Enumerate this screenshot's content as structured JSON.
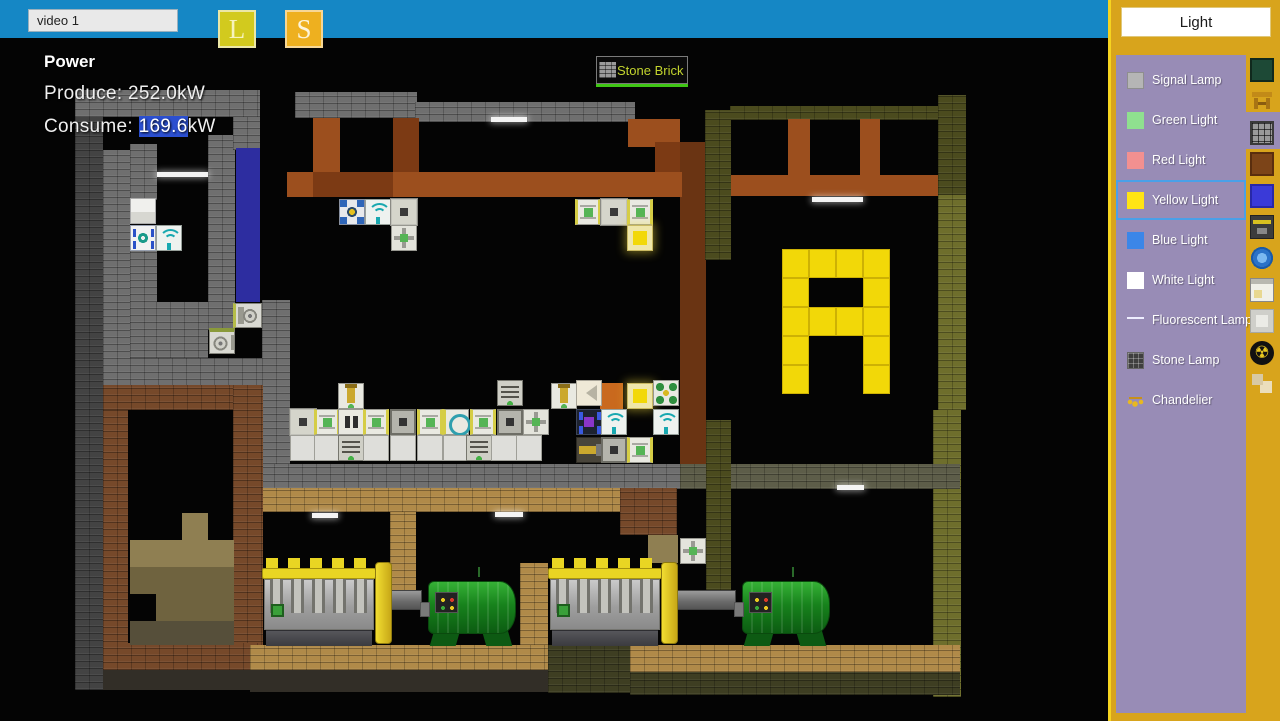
{
  "topbar": {
    "input_value": "video 1",
    "load_label": "L",
    "save_label": "S"
  },
  "power_panel": {
    "title": "Power",
    "produce": "Produce: 252.0kW",
    "consume_prefix": "Consume: ",
    "consume_highlight": "169.6",
    "consume_suffix": "kW"
  },
  "tooltip": {
    "label": "Stone Brick"
  },
  "sidebar": {
    "title": "Light",
    "items": [
      {
        "label": "Signal Lamp",
        "swatch": "signal",
        "selected": false
      },
      {
        "label": "Green Light",
        "swatch": "green",
        "selected": false
      },
      {
        "label": "Red Light",
        "swatch": "red",
        "selected": false
      },
      {
        "label": "Yellow Light",
        "swatch": "yellow",
        "selected": true
      },
      {
        "label": "Blue Light",
        "swatch": "blue",
        "selected": false
      },
      {
        "label": "White Light",
        "swatch": "white",
        "selected": false
      },
      {
        "label": "Fluorescent Lamp",
        "swatch": "fluorescent",
        "selected": false
      },
      {
        "label": "Stone Lamp",
        "swatch": "stone",
        "selected": false
      },
      {
        "label": "Chandelier",
        "swatch": "chandelier",
        "selected": false
      }
    ],
    "tabs": [
      {
        "icon": "nature-block-icon",
        "cls": "nature",
        "selected": false
      },
      {
        "icon": "furniture-icon",
        "cls": "furniture",
        "selected": false
      },
      {
        "icon": "lamp-grid-icon",
        "cls": "lamp",
        "selected": true
      },
      {
        "icon": "wood-block-icon",
        "cls": "wood",
        "selected": false
      },
      {
        "icon": "blue-block-icon",
        "cls": "blue",
        "selected": false
      },
      {
        "icon": "machine-icon",
        "cls": "machine",
        "selected": false
      },
      {
        "icon": "gear-coin-icon",
        "cls": "gear",
        "selected": false
      },
      {
        "icon": "window-icon",
        "cls": "window",
        "selected": false
      },
      {
        "icon": "plate-icon",
        "cls": "plate",
        "selected": false
      },
      {
        "icon": "radiation-icon",
        "cls": "radiation",
        "selected": false,
        "glyph": "☢"
      },
      {
        "icon": "blocks-icon",
        "cls": "blocks",
        "selected": false
      }
    ]
  },
  "colors": {
    "topbar_blue": "#1587c5",
    "sidebar_gold": "#d8a41c",
    "panel_purple": "#988cb6",
    "selection_blue": "#4aa0e8",
    "consume_highlight": "#2b4fd0",
    "lamp_yellow": "#f2d808",
    "tooltip_green": "#3fc614"
  },
  "world": {
    "blocks": [
      {
        "x": 75,
        "y": 90,
        "w": 185,
        "h": 27,
        "t": "stone"
      },
      {
        "x": 75,
        "y": 117,
        "w": 28,
        "h": 573,
        "t": "stone-d"
      },
      {
        "x": 103,
        "y": 150,
        "w": 27,
        "h": 237,
        "t": "stone"
      },
      {
        "x": 130,
        "y": 144,
        "w": 27,
        "h": 56,
        "t": "stone"
      },
      {
        "x": 130,
        "y": 250,
        "w": 27,
        "h": 108,
        "t": "stone"
      },
      {
        "x": 156,
        "y": 302,
        "w": 52,
        "h": 56,
        "t": "stone"
      },
      {
        "x": 208,
        "y": 135,
        "w": 27,
        "h": 195,
        "t": "stone"
      },
      {
        "x": 130,
        "y": 358,
        "w": 160,
        "h": 29,
        "t": "stone"
      },
      {
        "x": 233,
        "y": 117,
        "w": 27,
        "h": 33,
        "t": "stone"
      },
      {
        "x": 262,
        "y": 300,
        "w": 28,
        "h": 164,
        "t": "stone"
      },
      {
        "x": 236,
        "y": 148,
        "w": 24,
        "h": 154,
        "t": "blue"
      },
      {
        "x": 295,
        "y": 92,
        "w": 122,
        "h": 26,
        "t": "stone"
      },
      {
        "x": 415,
        "y": 102,
        "w": 220,
        "h": 20,
        "t": "stone"
      },
      {
        "x": 730,
        "y": 106,
        "w": 213,
        "h": 14,
        "t": "olive-d"
      },
      {
        "x": 313,
        "y": 118,
        "w": 27,
        "h": 56,
        "t": "wood"
      },
      {
        "x": 393,
        "y": 118,
        "w": 26,
        "h": 79,
        "t": "wood-d"
      },
      {
        "x": 628,
        "y": 119,
        "w": 52,
        "h": 28,
        "t": "wood"
      },
      {
        "x": 655,
        "y": 142,
        "w": 26,
        "h": 54,
        "t": "wood-d"
      },
      {
        "x": 680,
        "y": 142,
        "w": 26,
        "h": 322,
        "t": "wood-dd"
      },
      {
        "x": 287,
        "y": 172,
        "w": 395,
        "h": 25,
        "t": "wood"
      },
      {
        "x": 313,
        "y": 172,
        "w": 80,
        "h": 25,
        "t": "wood-d"
      },
      {
        "x": 730,
        "y": 175,
        "w": 213,
        "h": 21,
        "t": "wood"
      },
      {
        "x": 788,
        "y": 119,
        "w": 22,
        "h": 57,
        "t": "wood"
      },
      {
        "x": 860,
        "y": 119,
        "w": 20,
        "h": 57,
        "t": "wood"
      },
      {
        "x": 705,
        "y": 110,
        "w": 26,
        "h": 150,
        "t": "olive-d"
      },
      {
        "x": 938,
        "y": 95,
        "w": 28,
        "h": 100,
        "t": "olive-d"
      },
      {
        "x": 938,
        "y": 195,
        "w": 28,
        "h": 215,
        "t": "olive"
      },
      {
        "x": 933,
        "y": 410,
        "w": 28,
        "h": 287,
        "t": "olive"
      },
      {
        "x": 260,
        "y": 464,
        "w": 420,
        "h": 25,
        "t": "stone"
      },
      {
        "x": 680,
        "y": 464,
        "w": 280,
        "h": 25,
        "t": "stone-o"
      },
      {
        "x": 262,
        "y": 488,
        "w": 360,
        "h": 24,
        "t": "tan"
      },
      {
        "x": 620,
        "y": 488,
        "w": 57,
        "h": 47,
        "t": "brown"
      },
      {
        "x": 648,
        "y": 535,
        "w": 30,
        "h": 28,
        "t": "khaki1"
      },
      {
        "x": 706,
        "y": 420,
        "w": 25,
        "h": 170,
        "t": "olive-d"
      },
      {
        "x": 390,
        "y": 512,
        "w": 26,
        "h": 80,
        "t": "tan"
      },
      {
        "x": 520,
        "y": 563,
        "w": 28,
        "h": 82,
        "t": "tan"
      },
      {
        "x": 103,
        "y": 385,
        "w": 25,
        "h": 285,
        "t": "brown"
      },
      {
        "x": 103,
        "y": 385,
        "w": 157,
        "h": 25,
        "t": "brown"
      },
      {
        "x": 233,
        "y": 385,
        "w": 30,
        "h": 285,
        "t": "brown"
      },
      {
        "x": 103,
        "y": 643,
        "w": 157,
        "h": 27,
        "t": "brown"
      },
      {
        "x": 103,
        "y": 670,
        "w": 157,
        "h": 20,
        "t": "dark"
      },
      {
        "x": 182,
        "y": 513,
        "w": 26,
        "h": 27,
        "t": "khaki1"
      },
      {
        "x": 130,
        "y": 540,
        "w": 104,
        "h": 27,
        "t": "khaki1"
      },
      {
        "x": 130,
        "y": 567,
        "w": 104,
        "h": 27,
        "t": "khaki2"
      },
      {
        "x": 156,
        "y": 594,
        "w": 78,
        "h": 27,
        "t": "khaki2"
      },
      {
        "x": 130,
        "y": 621,
        "w": 104,
        "h": 24,
        "t": "khaki3"
      },
      {
        "x": 250,
        "y": 645,
        "w": 300,
        "h": 25,
        "t": "tan"
      },
      {
        "x": 250,
        "y": 670,
        "w": 298,
        "h": 22,
        "t": "dark"
      },
      {
        "x": 548,
        "y": 645,
        "w": 84,
        "h": 48,
        "t": "olive-dd"
      },
      {
        "x": 630,
        "y": 645,
        "w": 330,
        "h": 27,
        "t": "tan"
      },
      {
        "x": 630,
        "y": 672,
        "w": 330,
        "h": 23,
        "t": "olive-dd"
      },
      {
        "x": 600,
        "y": 383,
        "w": 23,
        "h": 26,
        "t": "orange"
      }
    ],
    "machines": [
      {
        "x": 339,
        "y": 199,
        "t": "bluecorner"
      },
      {
        "x": 365,
        "y": 199,
        "t": "wifi"
      },
      {
        "x": 391,
        "y": 199,
        "t": "graysq"
      },
      {
        "x": 391,
        "y": 225,
        "t": "arrow4"
      },
      {
        "x": 575,
        "y": 199,
        "t": "splitter"
      },
      {
        "x": 601,
        "y": 199,
        "t": "graysq"
      },
      {
        "x": 627,
        "y": 199,
        "t": "splitter"
      },
      {
        "x": 627,
        "y": 225,
        "t": "lampglow"
      },
      {
        "x": 338,
        "y": 383,
        "t": "piston"
      },
      {
        "x": 497,
        "y": 380,
        "t": "lined"
      },
      {
        "x": 551,
        "y": 383,
        "t": "piston"
      },
      {
        "x": 576,
        "y": 380,
        "t": "funnel"
      },
      {
        "x": 627,
        "y": 383,
        "t": "lampglow"
      },
      {
        "x": 653,
        "y": 380,
        "t": "green4"
      },
      {
        "x": 290,
        "y": 409,
        "t": "graysq"
      },
      {
        "x": 314,
        "y": 409,
        "t": "splitter"
      },
      {
        "x": 338,
        "y": 409,
        "t": "doubleslot"
      },
      {
        "x": 363,
        "y": 409,
        "t": "splitter"
      },
      {
        "x": 390,
        "y": 409,
        "t": "darksq"
      },
      {
        "x": 417,
        "y": 409,
        "t": "splitter"
      },
      {
        "x": 443,
        "y": 409,
        "t": "tealgear"
      },
      {
        "x": 470,
        "y": 409,
        "t": "splitter"
      },
      {
        "x": 497,
        "y": 409,
        "t": "darksq"
      },
      {
        "x": 523,
        "y": 409,
        "t": "arrow4"
      },
      {
        "x": 576,
        "y": 409,
        "t": "purple"
      },
      {
        "x": 601,
        "y": 409,
        "t": "wifi"
      },
      {
        "x": 653,
        "y": 409,
        "t": "wifi"
      },
      {
        "x": 290,
        "y": 435,
        "t": "plain"
      },
      {
        "x": 314,
        "y": 435,
        "t": "plain"
      },
      {
        "x": 338,
        "y": 435,
        "t": "lined"
      },
      {
        "x": 363,
        "y": 435,
        "t": "plain"
      },
      {
        "x": 390,
        "y": 435,
        "t": "plain"
      },
      {
        "x": 417,
        "y": 435,
        "t": "plain"
      },
      {
        "x": 443,
        "y": 435,
        "t": "plain"
      },
      {
        "x": 466,
        "y": 435,
        "t": "lined"
      },
      {
        "x": 491,
        "y": 435,
        "t": "plain"
      },
      {
        "x": 516,
        "y": 435,
        "t": "plain"
      },
      {
        "x": 576,
        "y": 437,
        "t": "pistonh"
      },
      {
        "x": 601,
        "y": 437,
        "t": "darksq"
      },
      {
        "x": 627,
        "y": 437,
        "t": "splitter"
      },
      {
        "x": 130,
        "y": 198,
        "t": "whitebox"
      },
      {
        "x": 130,
        "y": 225,
        "t": "bluebar"
      },
      {
        "x": 156,
        "y": 225,
        "t": "wifi"
      },
      {
        "x": 233,
        "y": 303,
        "t": "circle"
      },
      {
        "x": 209,
        "y": 328,
        "t": "circle2"
      },
      {
        "x": 680,
        "y": 538,
        "t": "arrow4"
      }
    ],
    "lamps": [
      {
        "x": 157,
        "y": 172,
        "w": 51
      },
      {
        "x": 491,
        "y": 117,
        "w": 36
      },
      {
        "x": 812,
        "y": 197,
        "w": 51
      },
      {
        "x": 312,
        "y": 513,
        "w": 26
      },
      {
        "x": 495,
        "y": 512,
        "w": 28
      },
      {
        "x": 837,
        "y": 485,
        "w": 27
      }
    ],
    "letter_a": {
      "x": 782,
      "y": 249,
      "tile_w": 27,
      "tile_h": 29,
      "pattern": [
        "1111",
        "1001",
        "1111",
        "1001",
        "1001"
      ]
    },
    "engines": [
      {
        "x": 262,
        "y": 558
      },
      {
        "x": 548,
        "y": 558
      }
    ],
    "shafts": [
      {
        "x": 386,
        "y": 590,
        "w": 36,
        "h": 20
      },
      {
        "x": 672,
        "y": 590,
        "w": 64,
        "h": 20
      }
    ],
    "generators": [
      {
        "x": 420,
        "y": 576
      },
      {
        "x": 734,
        "y": 576
      }
    ]
  }
}
